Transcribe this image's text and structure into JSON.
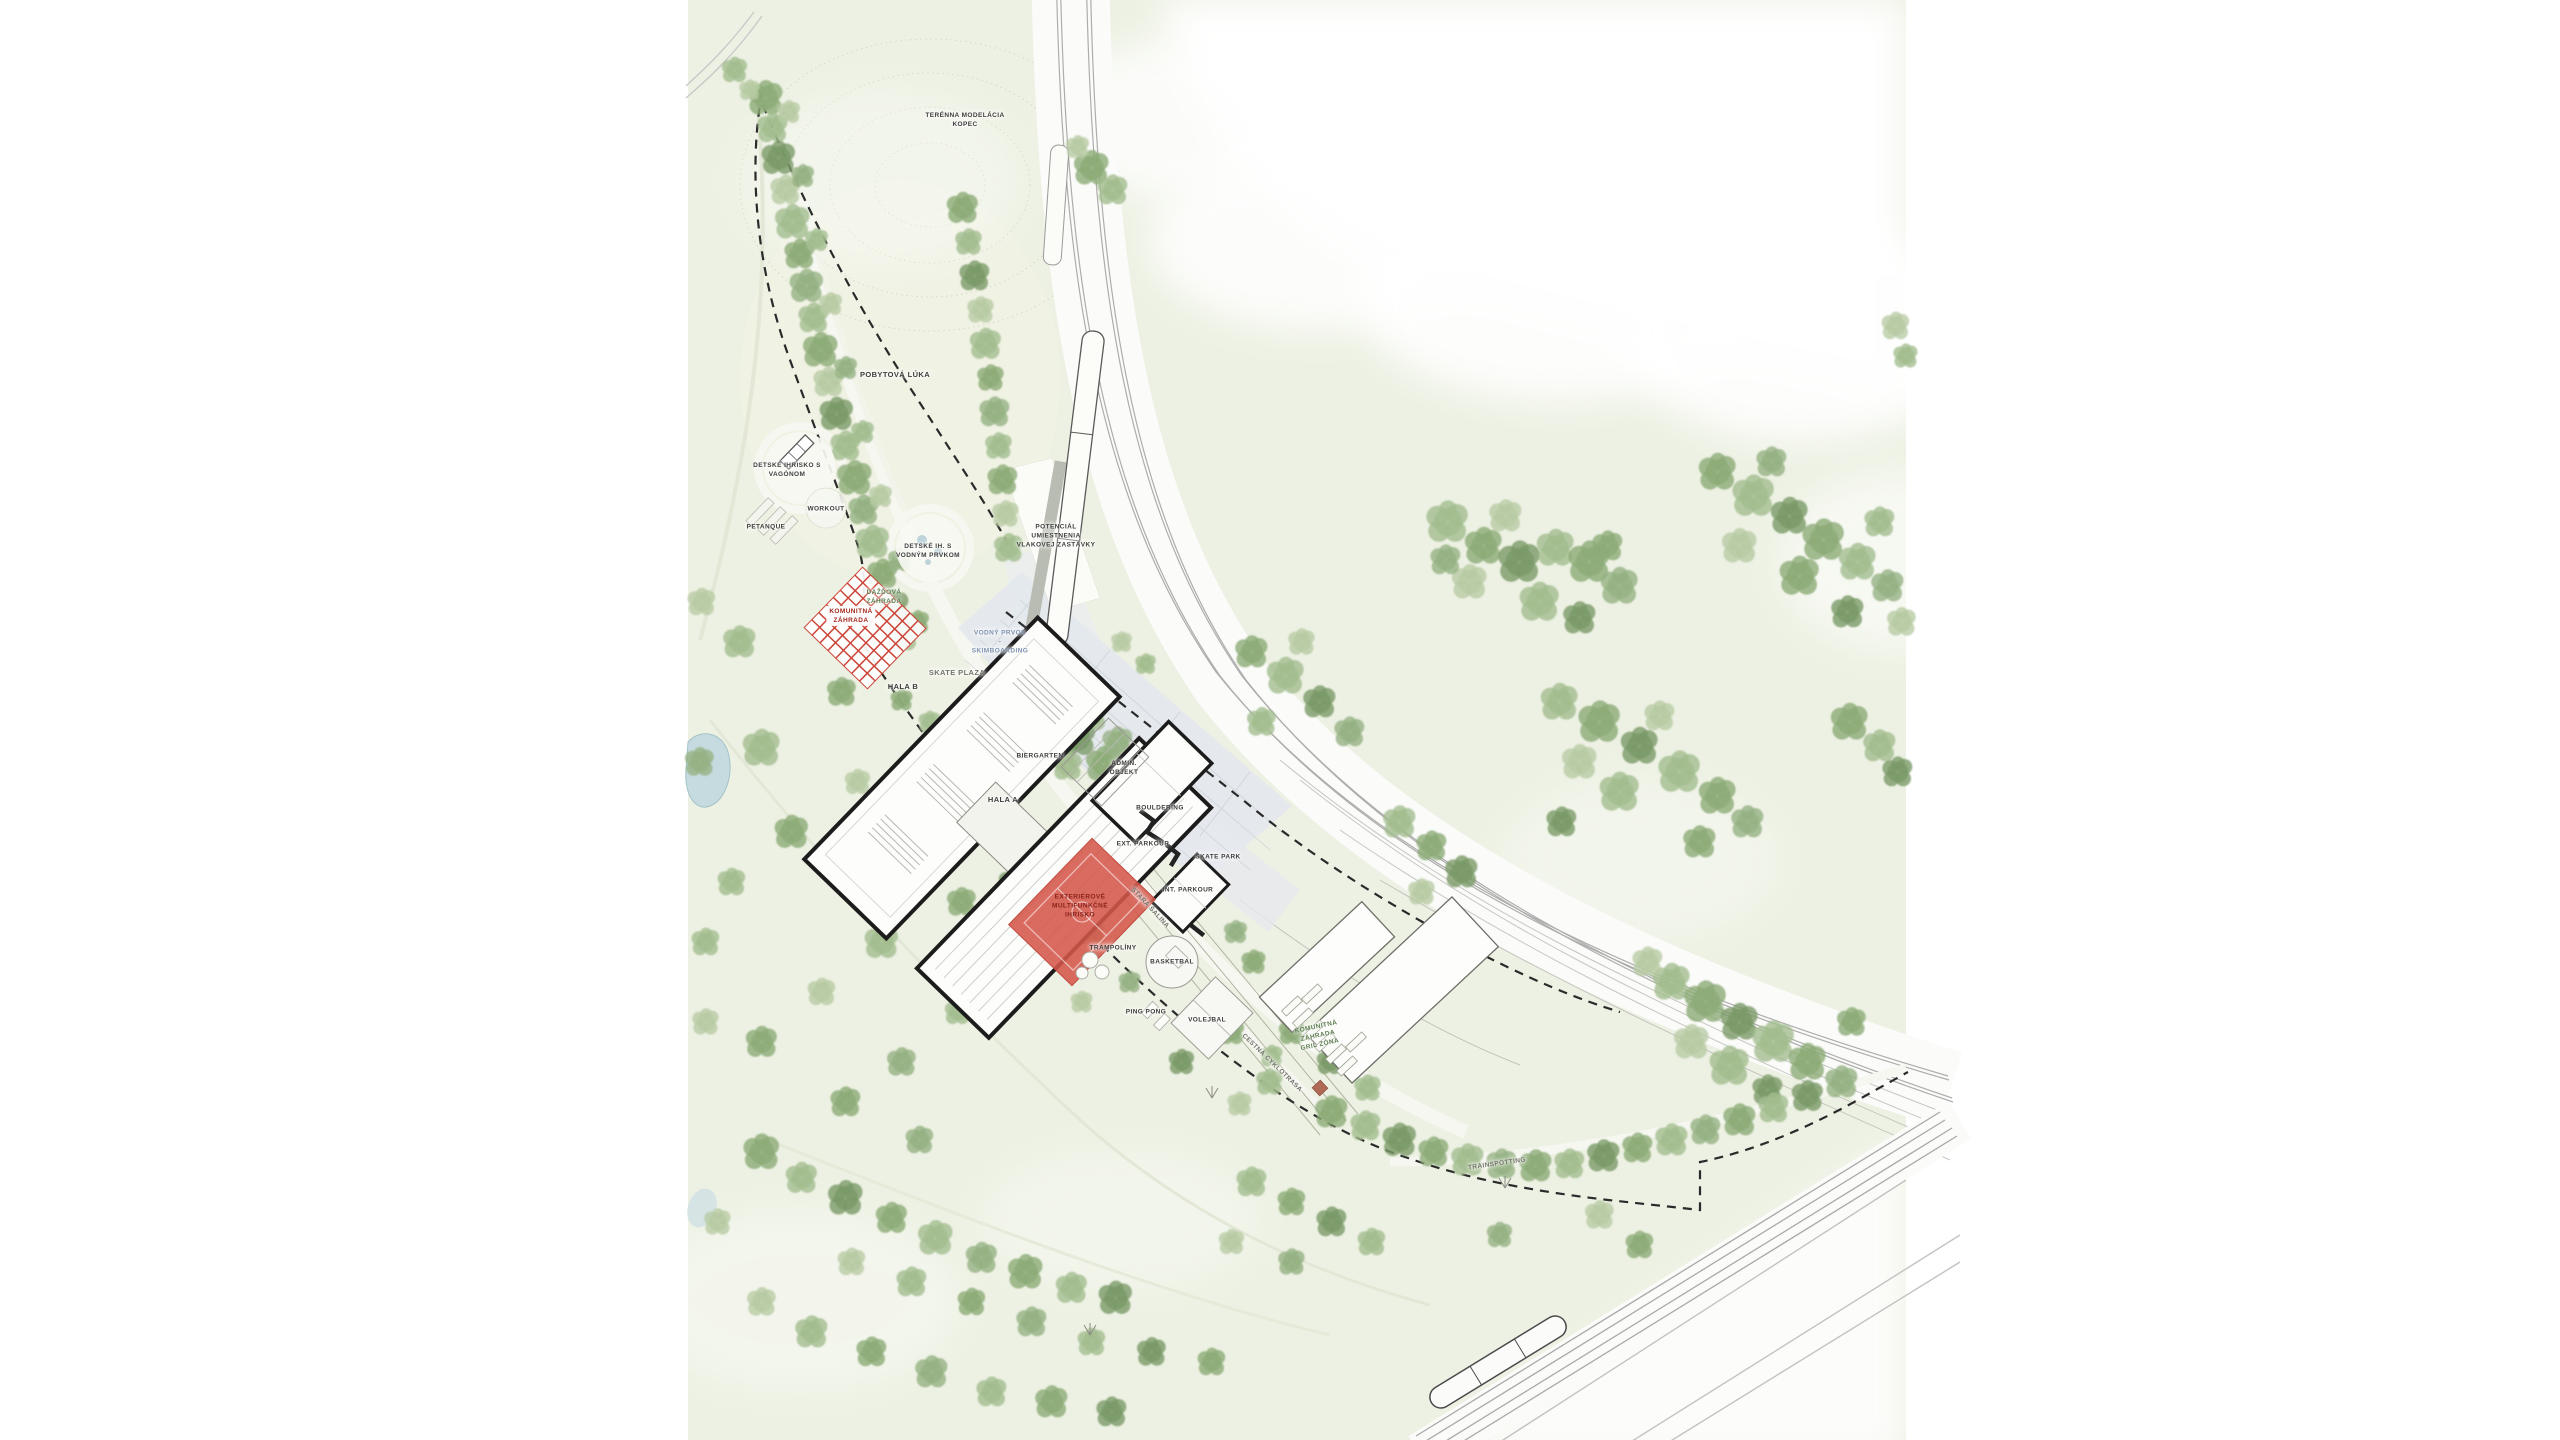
{
  "plan": {
    "labels": [
      {
        "id": "terrain-mound",
        "text": "TERÉNNA MODELÁCIA\nKOPEC"
      },
      {
        "id": "meadow",
        "text": "POBYTOVÁ LÚKA"
      },
      {
        "id": "playground-wagon",
        "text": "DETSKÉ IHRISKO S\nVAGÓNOM"
      },
      {
        "id": "petanque",
        "text": "PETANQUE"
      },
      {
        "id": "workout",
        "text": "WORKOUT"
      },
      {
        "id": "playground-water",
        "text": "DETSKÉ IH. S\nVODNÝM PRVKOM"
      },
      {
        "id": "rain-garden",
        "text": "DAŽĎOVÁ\nZÁHRADA"
      },
      {
        "id": "community-garden",
        "text": "KOMUNITNÁ\nZÁHRADA"
      },
      {
        "id": "hala-b",
        "text": "HALA B"
      },
      {
        "id": "skate-plaza",
        "text": "SKATE PLAZA"
      },
      {
        "id": "water-skimboarding",
        "text": "VODNÝ PRVOK\n-\nSKIMBOARDING"
      },
      {
        "id": "train-stop",
        "text": "POTENCIÁL\nUMIESTNENIA\nVLAKOVEJ ZASTÁVKY"
      },
      {
        "id": "hala-a",
        "text": "HALA A"
      },
      {
        "id": "biergarten",
        "text": "BIERGARTEN"
      },
      {
        "id": "admin-objekt",
        "text": "ADMIN.\nOBJEKT"
      },
      {
        "id": "bouldering",
        "text": "BOULDERING"
      },
      {
        "id": "ext-parkour",
        "text": "EXT. PARKOUR"
      },
      {
        "id": "skate-park",
        "text": "SKATE PARK"
      },
      {
        "id": "int-parkour",
        "text": "INT. PARKOUR"
      },
      {
        "id": "multi-court",
        "text": "EXTERIÉROVÉ\nMULTIFUNKČNÉ\nIHRISKO"
      },
      {
        "id": "salina",
        "text": "STARÁ ŠALINA"
      },
      {
        "id": "trampoliny",
        "text": "TRAMPOLÍNY"
      },
      {
        "id": "basketbal",
        "text": "BASKETBAL"
      },
      {
        "id": "ping-pong",
        "text": "PING PONG"
      },
      {
        "id": "volejbal",
        "text": "VOLEJBAL"
      },
      {
        "id": "cyklotrasa",
        "text": "CESTNÁ CYKLOTRASA"
      },
      {
        "id": "gril-zona",
        "text": "KOMUNITNÁ\nZÁHRADA\nGRIL ZÓNA"
      },
      {
        "id": "trainspotting",
        "text": "TRAINSPOTTING"
      }
    ],
    "colors": {
      "park_green": "#edf1e3",
      "tree_green": "#9ab585",
      "accent_red": "#d4564a",
      "water_blue": "#c6dbe0",
      "building_outline": "#1c1c1c",
      "rail_gray": "#adadad"
    }
  }
}
